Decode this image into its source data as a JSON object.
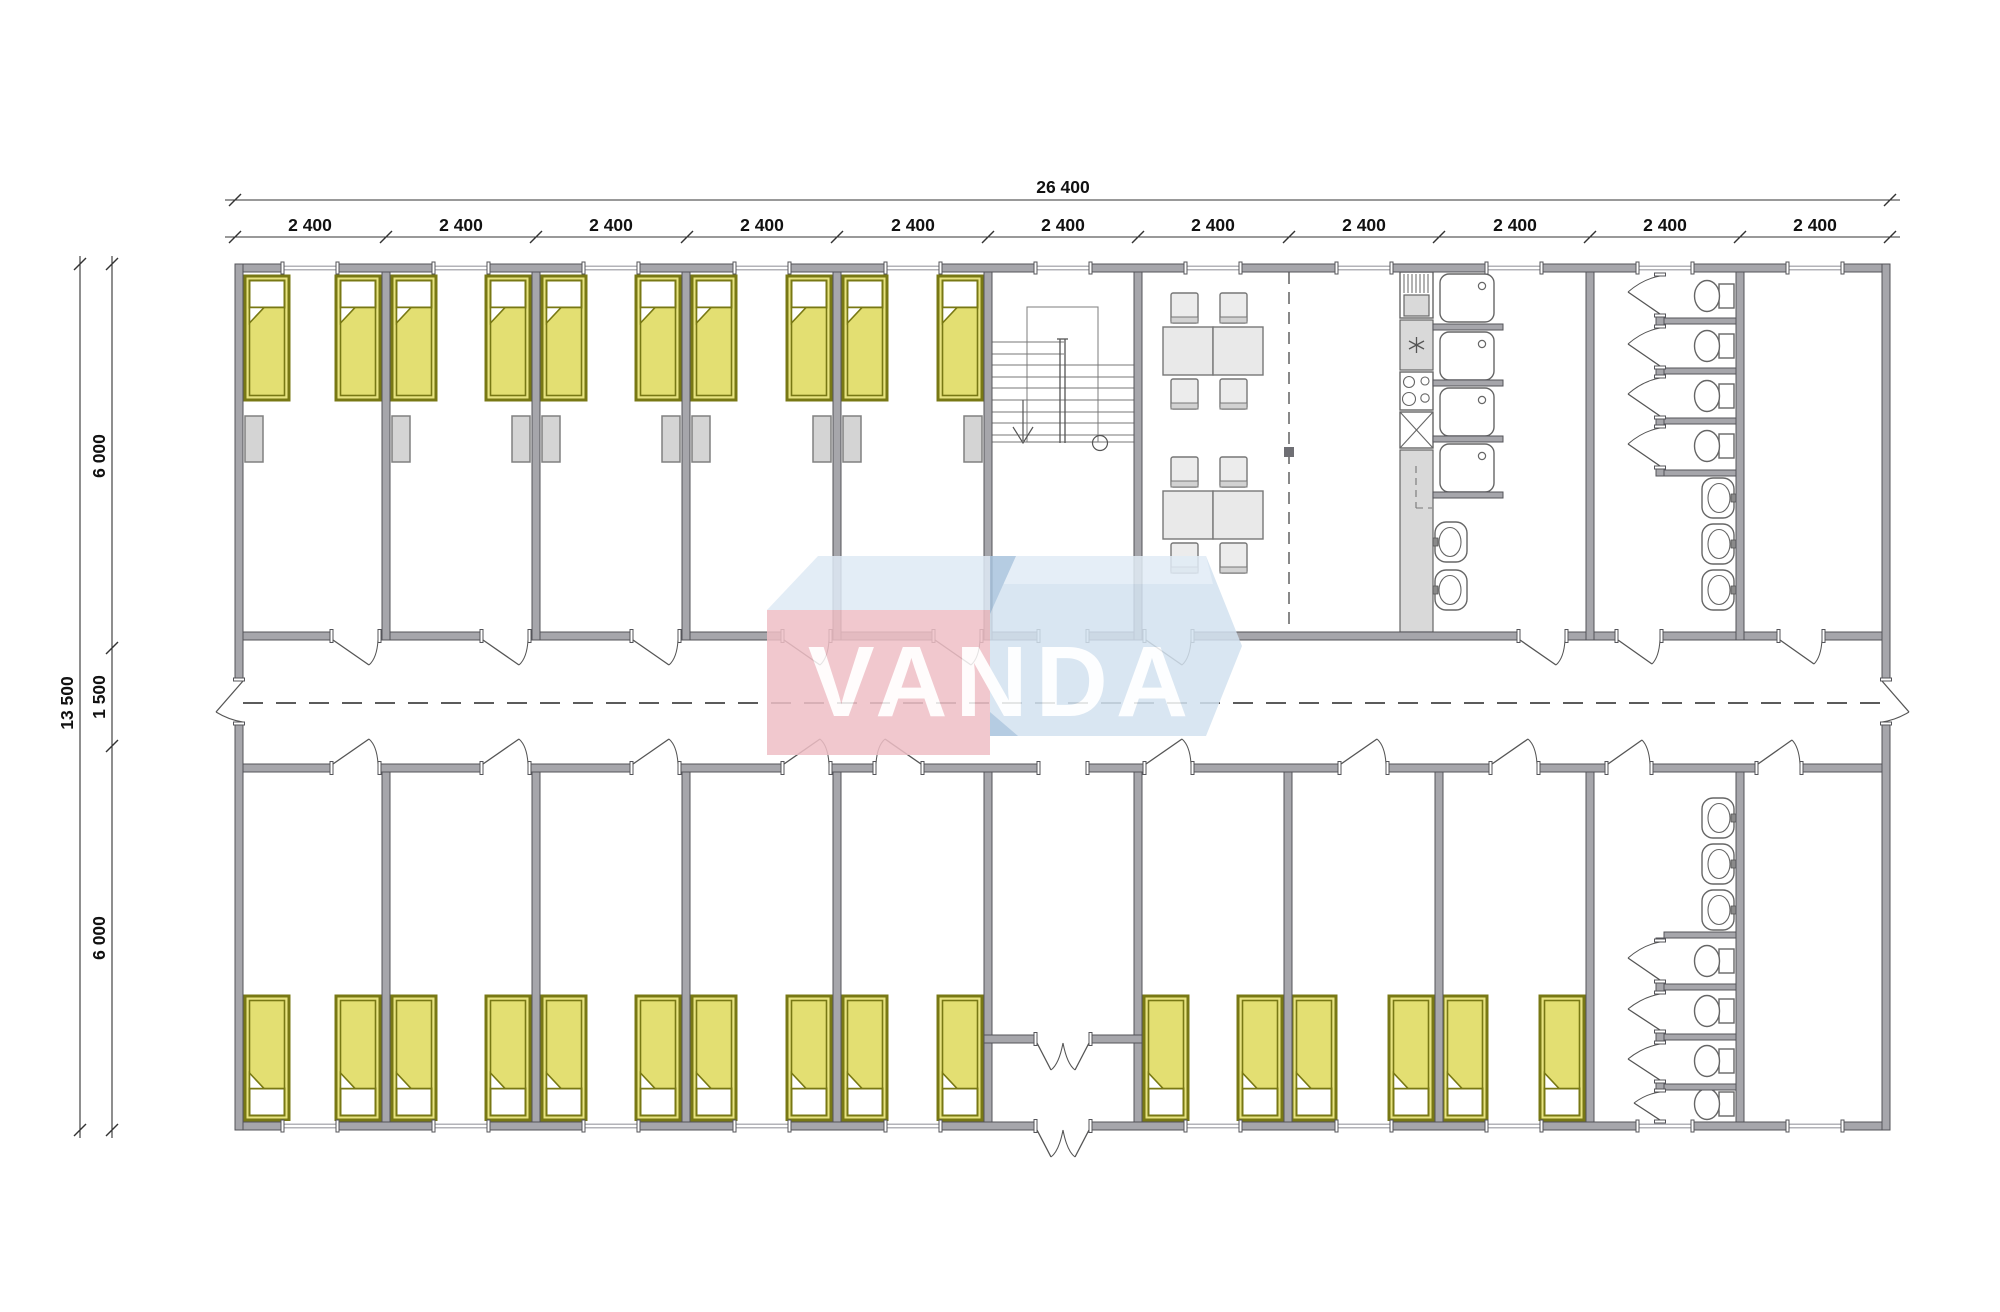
{
  "meta": {
    "drawing_type": "architectural floor plan",
    "subject": "modular dormitory building with bedrooms, staircase, dining room, kitchen, showers and toilets"
  },
  "watermark": {
    "text": "VANDA"
  },
  "dims": {
    "overall_width": "26 400",
    "modules": [
      "2 400",
      "2 400",
      "2 400",
      "2 400",
      "2 400",
      "2 400",
      "2 400",
      "2 400",
      "2 400",
      "2 400",
      "2 400"
    ],
    "overall_height": "13 500",
    "segments": [
      "6 000",
      "1 500",
      "6 000"
    ]
  },
  "plan": {
    "module_count": 11,
    "module_width_mm": 2400,
    "building": {
      "width_mm": 26400,
      "depth_mm": 13500,
      "top_zone_mm": 6000,
      "corridor_mm": 1500,
      "bottom_zone_mm": 6000
    },
    "zones": [
      "bedrooms top row",
      "staircase",
      "dining hall",
      "kitchen counter",
      "shower cabins",
      "toilet stalls top",
      "storage room top",
      "corridor",
      "bedrooms bottom row",
      "entrance vestibule",
      "toilet stalls bottom",
      "storage room bottom"
    ],
    "fixtures": {
      "beds": 26,
      "wardrobes": 9,
      "dining_tables": 2,
      "chairs": 8,
      "showers": 4,
      "toilets": 8,
      "wash_basins": 8,
      "staircases": 1,
      "entrance_double_doors": 2
    }
  },
  "colors": {
    "wall": "#a6a6ab",
    "bed_fill": "#e7e381",
    "bed_border": "#787814",
    "fixture_gray": "#d9d9d9",
    "logo_pink": "#efbfc6",
    "logo_blue": "#d3e2f0",
    "logo_blue_light": "#e1ecf6",
    "logo_blue_dark": "#a9c4de"
  }
}
